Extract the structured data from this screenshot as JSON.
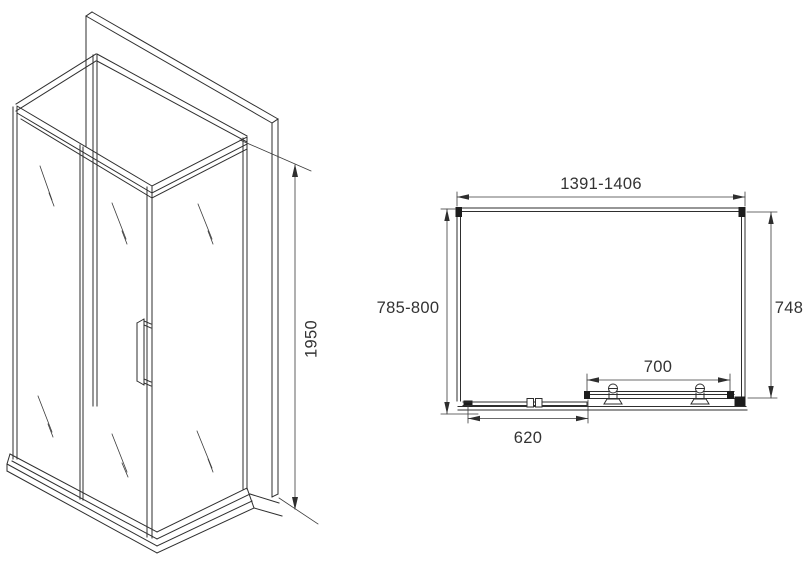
{
  "drawing": {
    "type": "shower-enclosure-technical-drawing",
    "colors": {
      "line": "#2e2e2e",
      "hardware_dark": "#1c1c1c",
      "text": "#333333",
      "background": "#ffffff"
    },
    "views": {
      "isometric": {
        "name": "isometric-view",
        "dimensions": {
          "height": "1950"
        }
      },
      "plan": {
        "name": "plan-view",
        "dimensions": {
          "overall_width": "1391-1406",
          "overall_depth": "785-800",
          "side_panel": "748",
          "door_opening": "700",
          "fixed_panel": "620"
        }
      }
    }
  }
}
